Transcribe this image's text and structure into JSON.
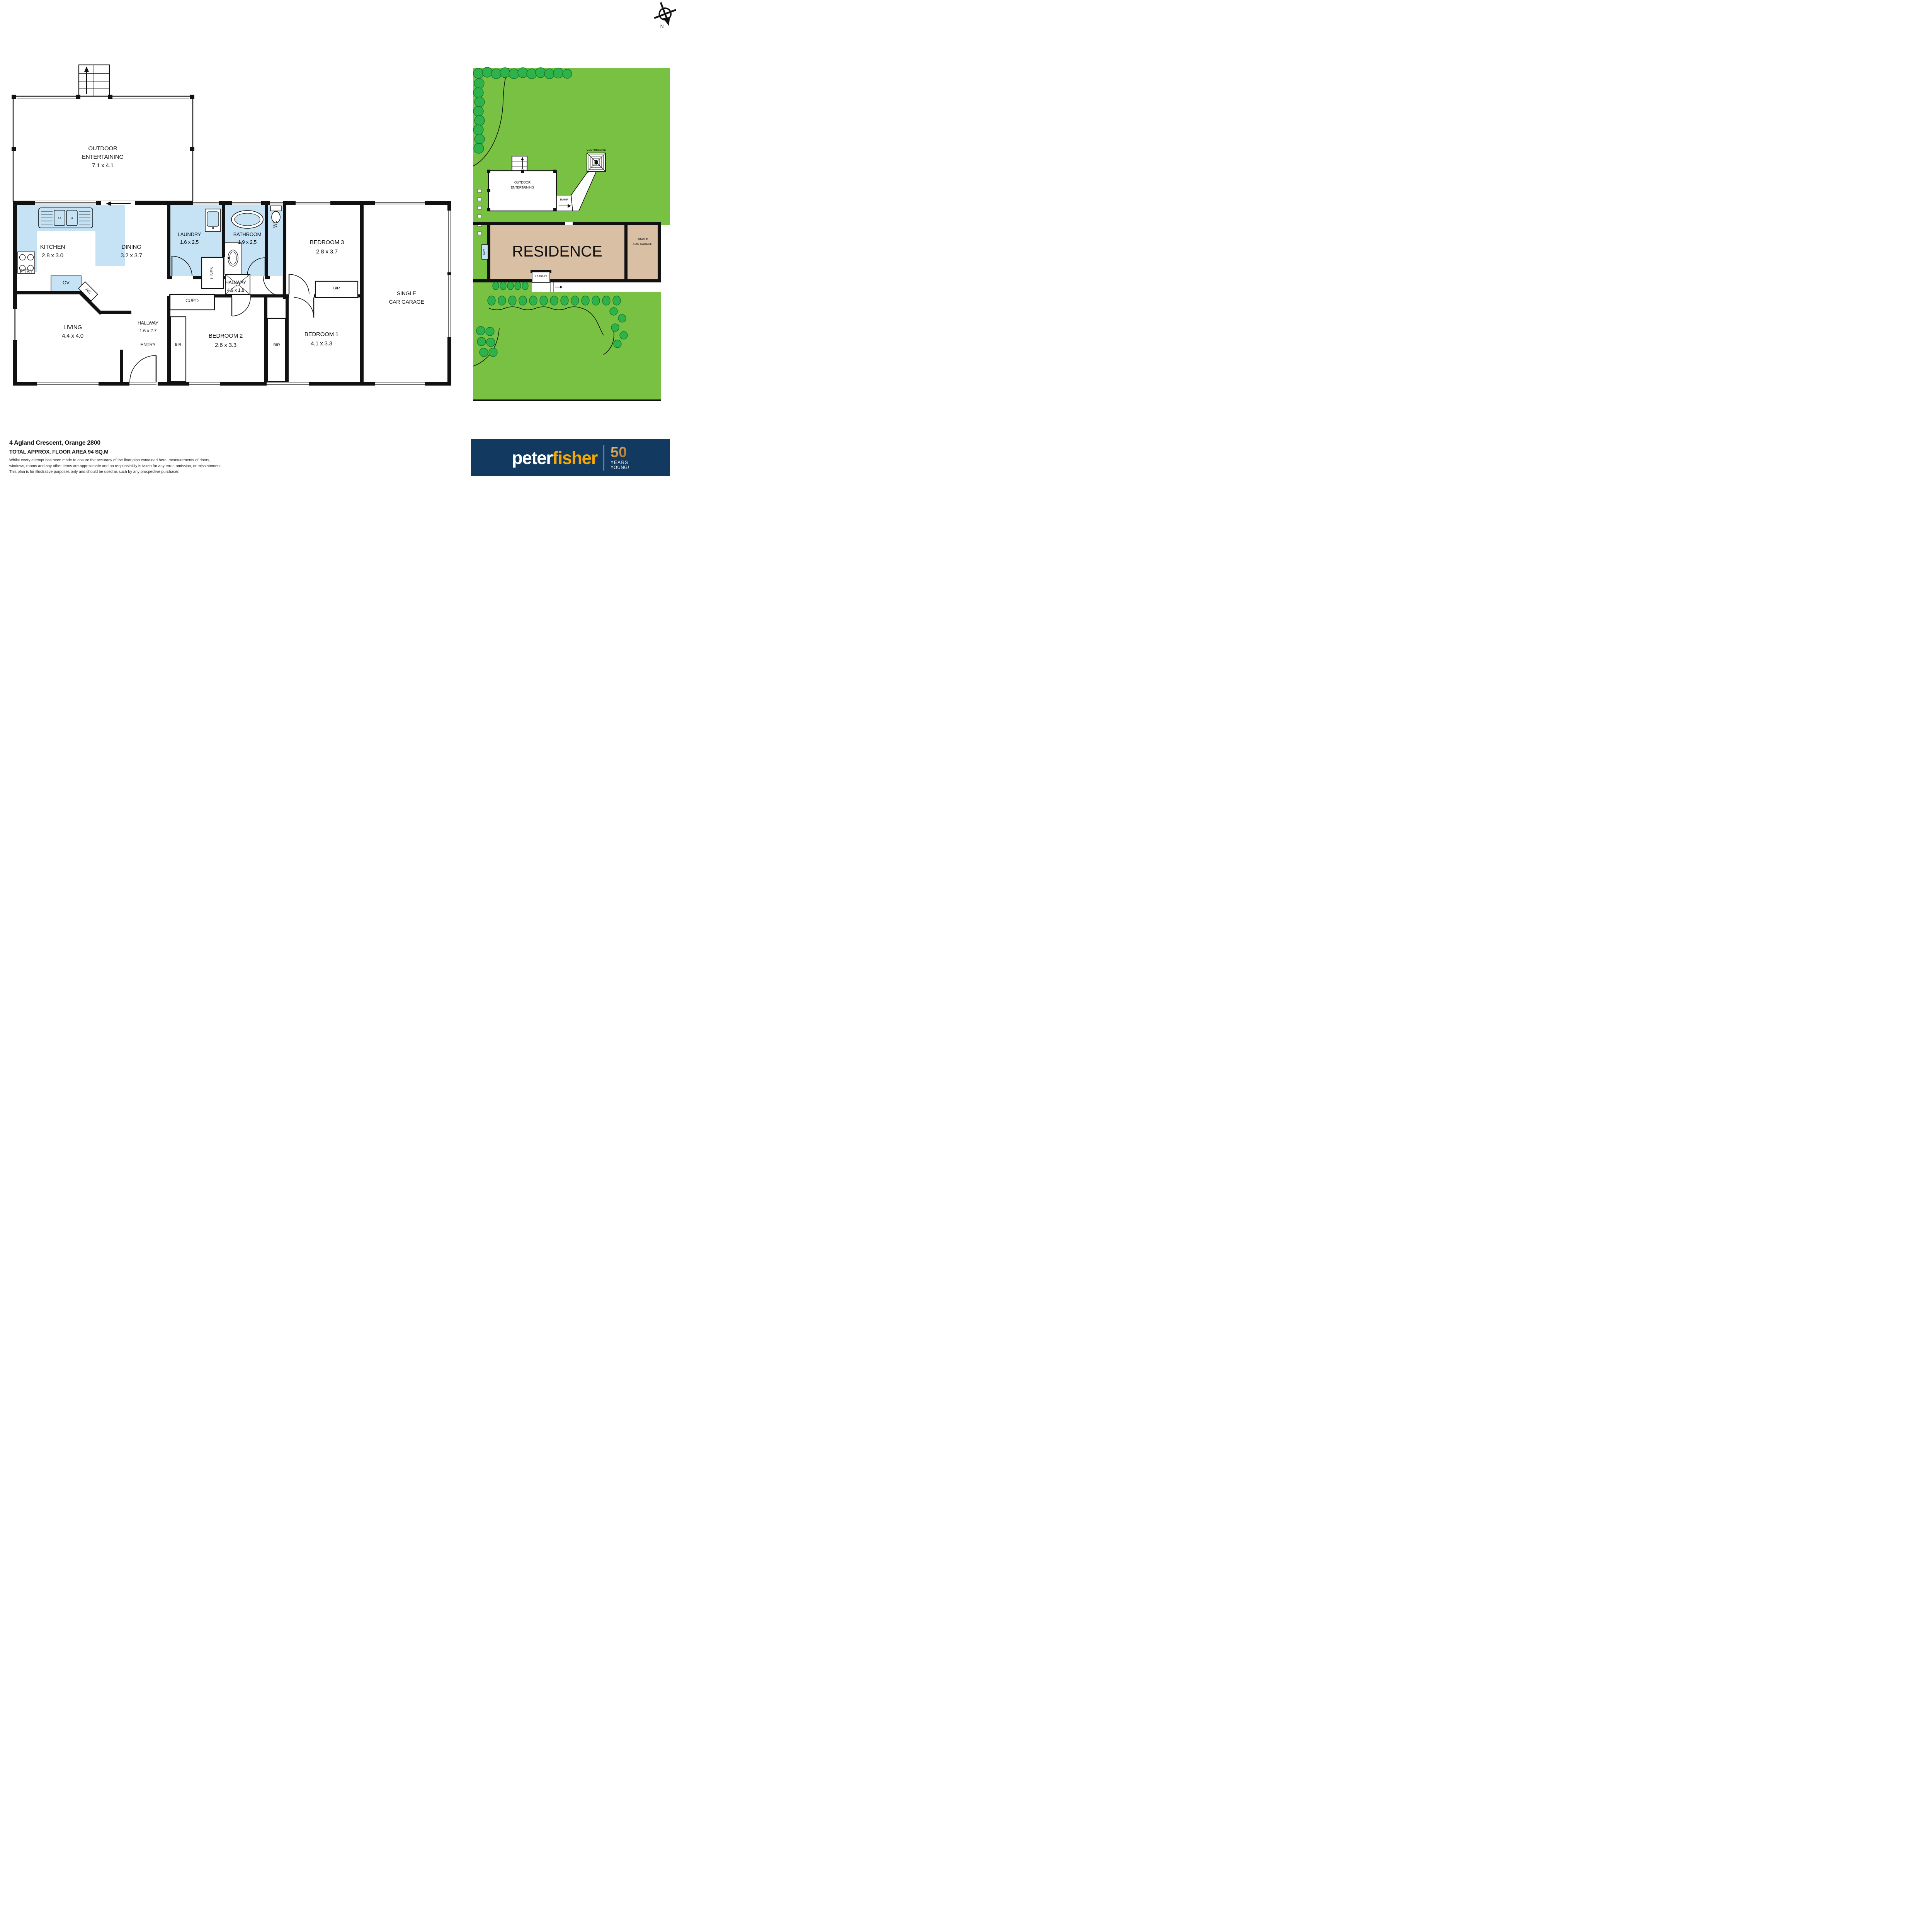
{
  "compass": {
    "north_label": "N"
  },
  "floor_plan": {
    "outdoor": {
      "line1": "OUTDOOR",
      "line2": "ENTERTAINING",
      "dims": "7.1 x 4.1"
    },
    "kitchen": {
      "name": "KITCHEN",
      "dims": "2.8 x 3.0"
    },
    "dining": {
      "name": "DINING",
      "dims": "3.2 x 3.7"
    },
    "laundry": {
      "name": "LAUNDRY",
      "dims": "1.6 x 2.5"
    },
    "bathroom": {
      "name": "BATHROOM",
      "dims": "1.9 x 2.5"
    },
    "bedroom3": {
      "name": "BEDROOM 3",
      "dims": "2.8 x 3.7"
    },
    "hallway_main": {
      "name": "HALLWAY",
      "dims": "4.9 x 1.8"
    },
    "hallway_entry": {
      "name": "HALLWAY",
      "dims": "1.6 x 2.7"
    },
    "living": {
      "name": "LIVING",
      "dims": "4.4 x 4.0"
    },
    "bedroom2": {
      "name": "BEDROOM 2",
      "dims": "2.6 x 3.3"
    },
    "bedroom1": {
      "name": "BEDROOM 1",
      "dims": "4.1 x 3.3"
    },
    "garage": {
      "line1": "SINGLE",
      "line2": "CAR GARAGE"
    },
    "small": {
      "ptry": "P'TRY",
      "ov": "OV",
      "ac": "A/C",
      "linen": "LINEN",
      "wc": "WC",
      "cupd": "CUP'D",
      "entry": "ENTRY",
      "bir": "BIR"
    }
  },
  "site_plan": {
    "residence": "RESIDENCE",
    "outdoor_line1": "OUTDOOR",
    "outdoor_line2": "ENTERTAINING",
    "clothesline": "CLOTHESLINE",
    "ramp": "RAMP",
    "porch": "PORCH",
    "hwt": "HWT",
    "garage_line1": "SINGLE",
    "garage_line2": "CAR GARAGE"
  },
  "footer": {
    "address": "4 Agland Crescent, Orange 2800",
    "area": "TOTAL APPROX. FLOOR AREA 94 SQ.M",
    "disclaimer1": "Whilst every attempt has been made to ensure the accuracy of the floor plan contained here, measurements of doors,",
    "disclaimer2": "windows, rooms and any other items are approximate and no responsibility is taken for any error, omission, or misstatement.",
    "disclaimer3": "This plan is for illustrative purposes only and should be used as such by any prospective purchaser."
  },
  "logo": {
    "peter": "peter",
    "fisher": "fisher",
    "fifty": "50",
    "years": "YEARS",
    "young": "YOUNG!"
  },
  "colors": {
    "wet": "#c5e3f4",
    "grass": "#79c143",
    "shrub": "#2db34a",
    "shrub_dark": "#0b6b33",
    "tan": "#d9c0a5",
    "navy": "#12395f",
    "gold": "#f6a800",
    "wall": "#0d0d0d"
  }
}
